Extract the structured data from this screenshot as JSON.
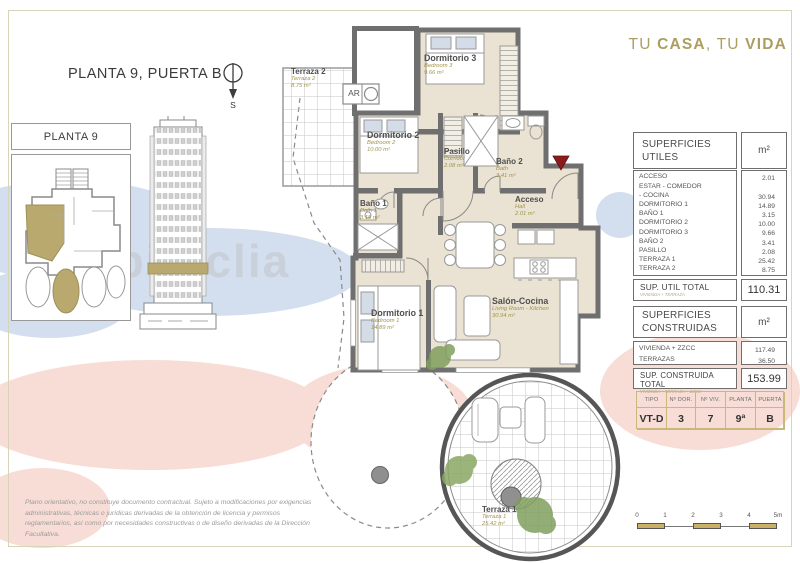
{
  "page": {
    "title": "PLANTA 9, PUERTA B",
    "compass_south": "S",
    "watermark": "habitaclia",
    "brand": {
      "w1": "TU ",
      "w2": "CASA",
      "w3": ", ",
      "w4": "TU ",
      "w5": "VIDA"
    },
    "disclaimer": "Plano orientativo, no constituye documento contractual. Sujeto a modificaciones por exigencias administrativas, técnicas o jurídicas derivadas de la obtención de licencia y permisos reglamentarios, así como por necesidades constructivas o de diseño derivadas de la Dirección Facultativa.",
    "colors": {
      "accent_gold": "#ab9e60",
      "wall_gray": "#6f6f6f",
      "floor_beige": "#eae2d2",
      "highlight_khaki": "#b9a96f",
      "blob_pink": "#f7ddd6",
      "blob_blue": "#d3dfee",
      "entrance_red": "#8c1b1b",
      "table_border_khaki": "#c9b87c"
    }
  },
  "key_plan": {
    "title": "PLANTA 9"
  },
  "plan": {
    "ar_label": "AR",
    "rooms": [
      {
        "name": "Terraza 2",
        "en": "Terraza 2",
        "area": "8.75 m²"
      },
      {
        "name": "Dormitorio 3",
        "en": "Bedroom 3",
        "area": "9.66 m²"
      },
      {
        "name": "Dormitorio 2",
        "en": "Bedroom 2",
        "area": "10.00 m²"
      },
      {
        "name": "Pasillo",
        "en": "Corridor",
        "area": "2.08 m²"
      },
      {
        "name": "Baño 2",
        "en": "Bath",
        "area": "3.41 m²"
      },
      {
        "name": "Acceso",
        "en": "Hall",
        "area": "2.01 m²"
      },
      {
        "name": "Baño 1",
        "en": "Bath 1",
        "area": "3.15 m²"
      },
      {
        "name": "Dormitorio 1",
        "en": "Bedroom 1",
        "area": "14.89 m²"
      },
      {
        "name": "Salón-Cocina",
        "en": "Living Room - Kitchen",
        "area": "30.94 m²"
      },
      {
        "name": "Terraza 1",
        "en": "Terraza 1",
        "area": "25.42 m²"
      }
    ]
  },
  "superficies_utiles": {
    "title": "SUPERFICIES UTILES",
    "unit": "m²",
    "rows": [
      {
        "label": "ACCESO",
        "value": "2.01"
      },
      {
        "label": "ESTAR - COMEDOR\n- COCINA",
        "value": "30.94"
      },
      {
        "label": "DORMITORIO 1",
        "value": "14.89"
      },
      {
        "label": "BAÑO 1",
        "value": "3.15"
      },
      {
        "label": "DORMITORIO 2",
        "value": "10.00"
      },
      {
        "label": "DORMITORIO 3",
        "value": "9.66"
      },
      {
        "label": "BAÑO 2",
        "value": "3.41"
      },
      {
        "label": "PASILLO",
        "value": "2.08"
      },
      {
        "label": "TERRAZA 1",
        "value": "25.42"
      },
      {
        "label": "TERRAZA 2",
        "value": "8.75"
      }
    ],
    "total_label": "SUP. UTIL TOTAL",
    "total_sub": "VIVIENDA + TERRAZA",
    "total_value": "110.31"
  },
  "superficies_construidas": {
    "title": "SUPERFICIES CONSTRUIDAS",
    "unit": "m²",
    "rows": [
      {
        "label": "VIVIENDA + ZZCC",
        "value": "117.49"
      },
      {
        "label": "TERRAZAS",
        "value": "36.50"
      }
    ],
    "total_label": "SUP. CONSTRUIDA TOTAL",
    "total_sub": "VIVIENDA + TERRAZA + ZZCC",
    "total_value": "153.99"
  },
  "tipo_table": {
    "headers": [
      "TIPO",
      "Nº DOR.",
      "Nº VIV.",
      "PLANTA",
      "PUERTA"
    ],
    "values": [
      "VT-D",
      "3",
      "7",
      "9ª",
      "B"
    ]
  },
  "scale_bar": {
    "ticks": [
      "0",
      "1",
      "2",
      "3",
      "4",
      "5m"
    ]
  }
}
